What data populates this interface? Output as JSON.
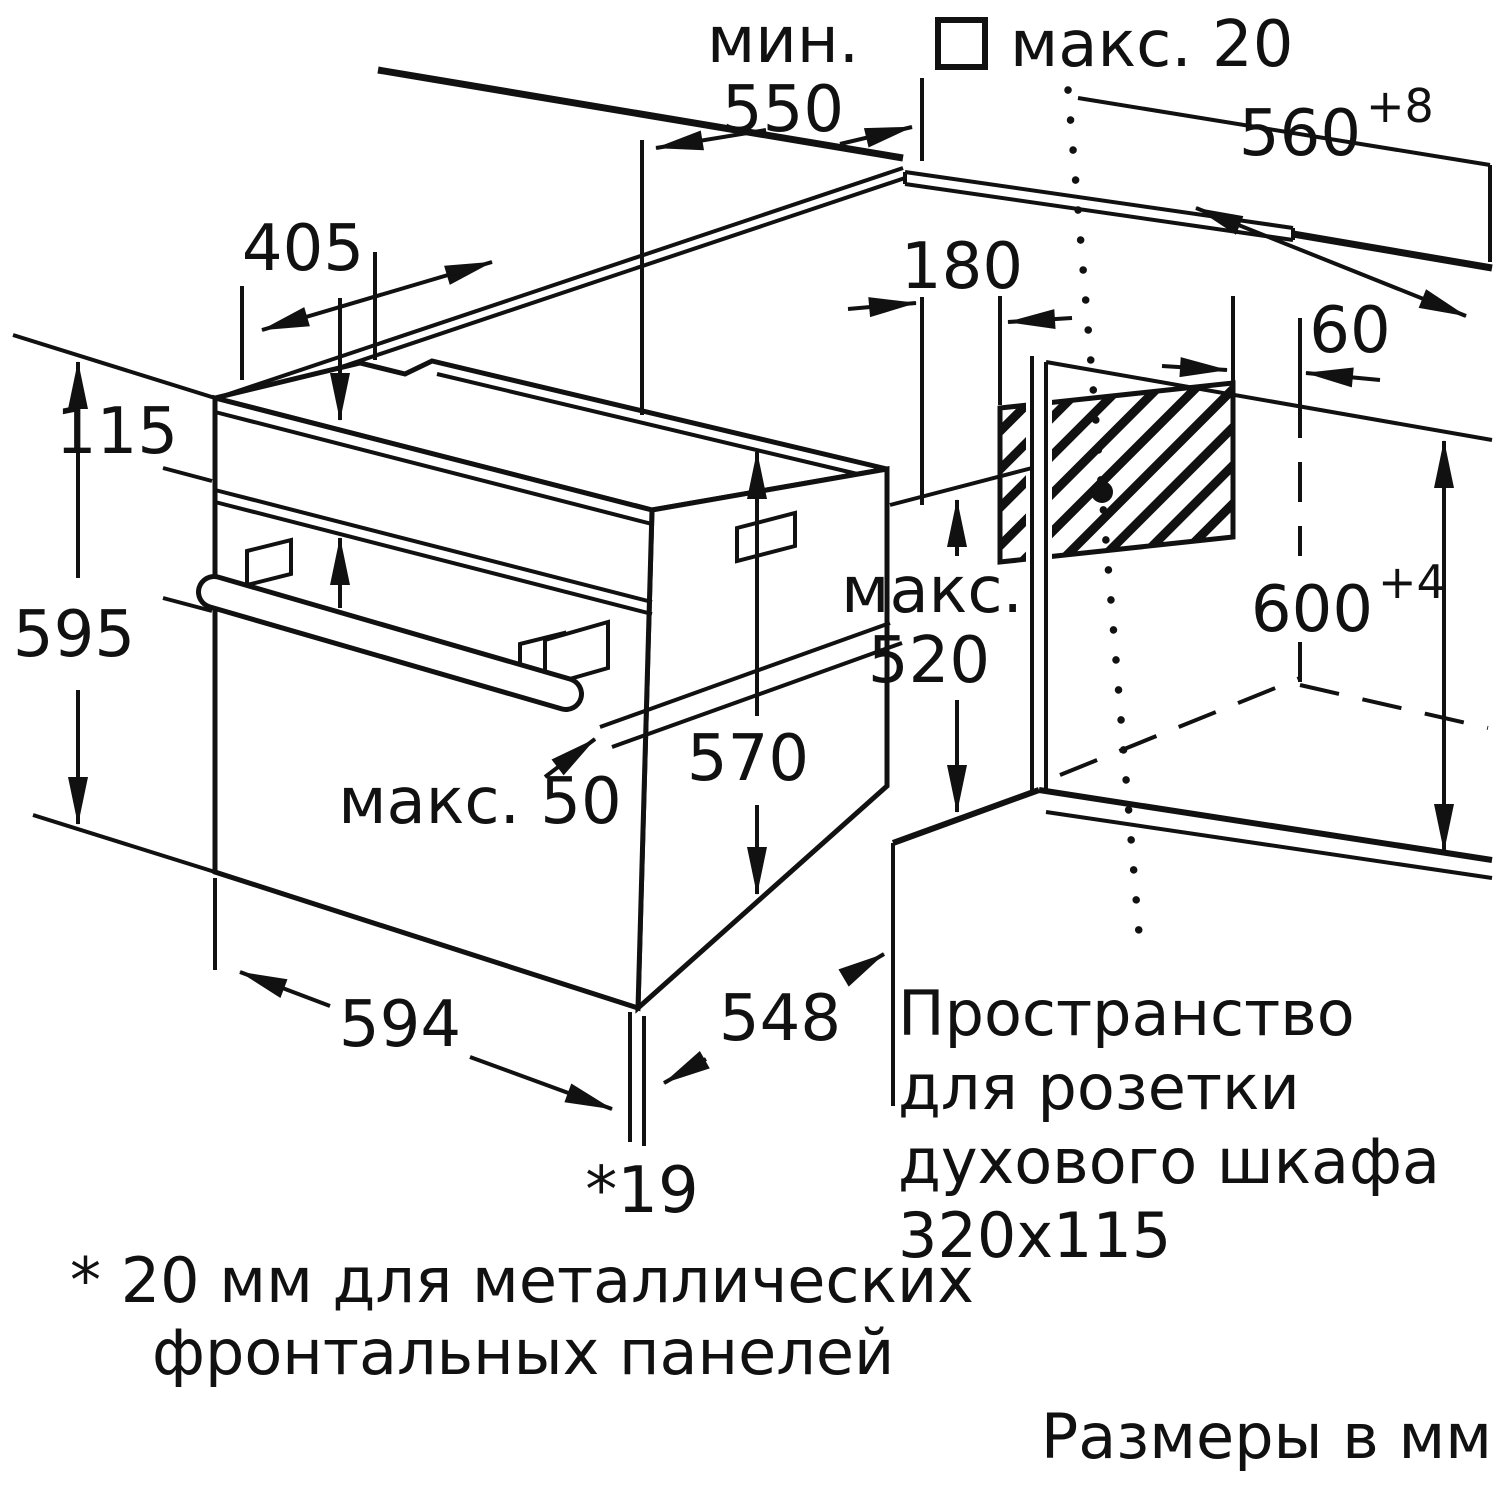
{
  "diagram": {
    "title_hint": "Built-in oven installation drawing",
    "units_note": "Размеры в мм",
    "footnote_line1": "* 20 мм для металлических",
    "footnote_line2": "фронтальных панелей",
    "socket_note": [
      "Пространство",
      "для розетки",
      "духового шкафа",
      "320x115"
    ],
    "dims": {
      "min_word": "мин.",
      "min_550": "550",
      "max_20": "макс. 20",
      "d560": "560",
      "d560_tol": "+8",
      "d405": "405",
      "d115": "115",
      "d595": "595",
      "d180": "180",
      "d60": "60",
      "max_word": "макс.",
      "max_520": "520",
      "d570": "570",
      "d600": "600",
      "d600_tol": "+4",
      "max_50": "макс. 50",
      "d594": "594",
      "d548": "548",
      "d19": "*19"
    },
    "colors": {
      "ink": "#111111",
      "paper": "#ffffff"
    }
  }
}
